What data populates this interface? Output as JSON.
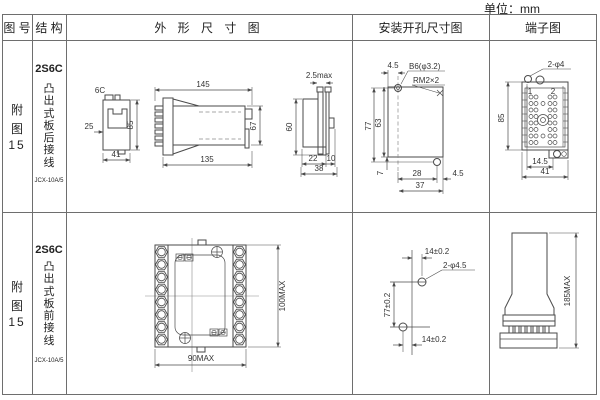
{
  "unit_label": "单位：mm",
  "headers": {
    "fig_no": "图 号",
    "structure": "结 构",
    "outline": "外 形 尺 寸 图",
    "mounting": "安装开孔尺寸图",
    "terminal": "端子图"
  },
  "rows": [
    {
      "fig": {
        "l1": "附",
        "l2": "图",
        "l3": "15"
      },
      "structure": {
        "model": "2S6C",
        "desc": "凸出式板后接线",
        "code": "JCX-10A/5"
      },
      "outline": {
        "top_view_label": "6C",
        "d25": "25",
        "d85": "85",
        "d41": "41",
        "d145": "145",
        "d135": "135",
        "d67": "67",
        "d2_5max": "2.5max",
        "d60": "60",
        "d22": "22",
        "d10": "10",
        "d38": "38"
      },
      "mounting": {
        "d4_5_top": "4.5",
        "hole_label": "B6(φ3.2)",
        "thread_label": "RM2×2",
        "d77": "77",
        "d63": "63",
        "d7": "7",
        "d28": "28",
        "d37": "37",
        "d4_5_br": "4.5"
      },
      "terminal": {
        "holes_label": "2-φ4",
        "n1": "1",
        "n2": "2",
        "d85": "85",
        "d14_5": "14.5",
        "d41": "41"
      }
    },
    {
      "fig": {
        "l1": "附",
        "l2": "图",
        "l3": "15"
      },
      "structure": {
        "model": "2S6C",
        "desc": "凸出式板前接线",
        "code": "JCX-10A/5"
      },
      "outline": {
        "d90max": "90MAX",
        "d100max": "100MAX"
      },
      "mounting": {
        "d14_top": "14±0.2",
        "holes_label": "2-φ4.5",
        "d77": "77±0.2",
        "d14_bottom": "14±0.2"
      },
      "terminal": {
        "d185max": "185MAX"
      }
    }
  ]
}
